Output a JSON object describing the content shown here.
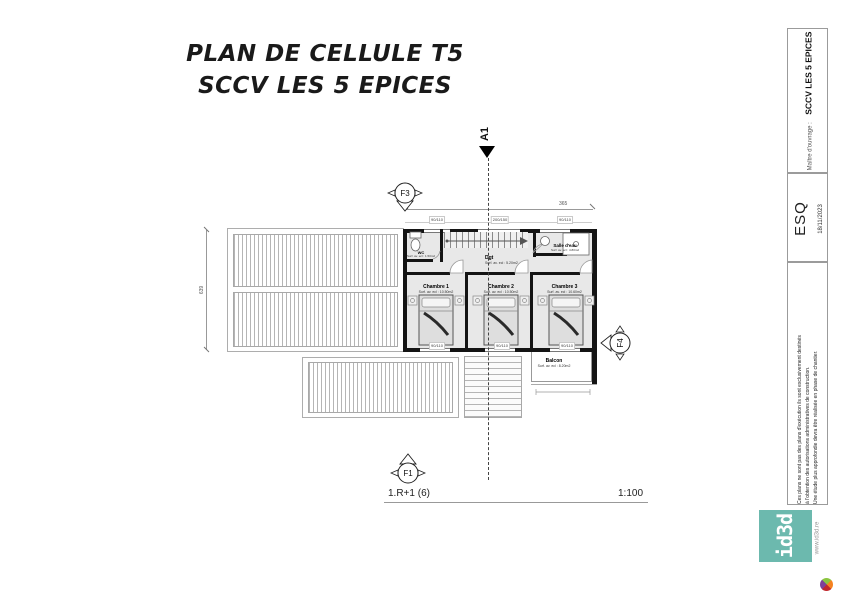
{
  "title": {
    "line1": "PLAN DE CELLULE T5",
    "line2": "SCCV LES 5 EPICES"
  },
  "titleblock": {
    "client_label": "Maître d'ouvrage :",
    "client_name": "SCCV LES 5 EPICES",
    "phase": "ESQ",
    "date": "18/11/2023",
    "disclaimer": {
      "line1": "Ces plans ne sont pas des plans d'exécution ils sont exclusivement destinés",
      "line2": "à l'obtention des autorisations administratives de construction.",
      "line3": "Une étude plus approfondie devra être réalisée en phase de chantier."
    },
    "logo_text": "id3d",
    "website": "www.id3d.re"
  },
  "plan": {
    "rooms": {
      "wc": {
        "name": "WC",
        "area": "Surf. av. ecl : 1.50m2"
      },
      "dgt": {
        "name": "Dgt",
        "area": "Surf. av. ecl : 5.20m2"
      },
      "sde": {
        "name": "Salle d'eau",
        "area": "Surf. av. ecl : 4.80m2"
      },
      "ch1": {
        "name": "Chambre 1",
        "area": "Surf. av. ecl : 10.50m2"
      },
      "ch2": {
        "name": "Chambre 2",
        "area": "Surf. av. ecl : 10.50m2"
      },
      "ch3": {
        "name": "Chambre 3",
        "area": "Surf. av. ecl : 10.60m2"
      },
      "balcon": {
        "name": "Balcon",
        "area": "Surf. av. ecl : 8.20m2"
      }
    },
    "markers": {
      "f3": "F3",
      "f1": "F1",
      "f4": "F4",
      "a1": "A1"
    },
    "dimensions": {
      "overall_width_top": "365",
      "overall_height_left": "639",
      "windows_top": [
        "90/110",
        "200/150",
        "90/110"
      ],
      "windows_bottom": [
        "90/110",
        "90/110",
        "90/110"
      ]
    }
  },
  "footer": {
    "plan_ref": "1.R+1 (6)",
    "scale": "1:100"
  },
  "colors": {
    "logo_teal": "#6cb9ae",
    "wall": "#141414"
  }
}
